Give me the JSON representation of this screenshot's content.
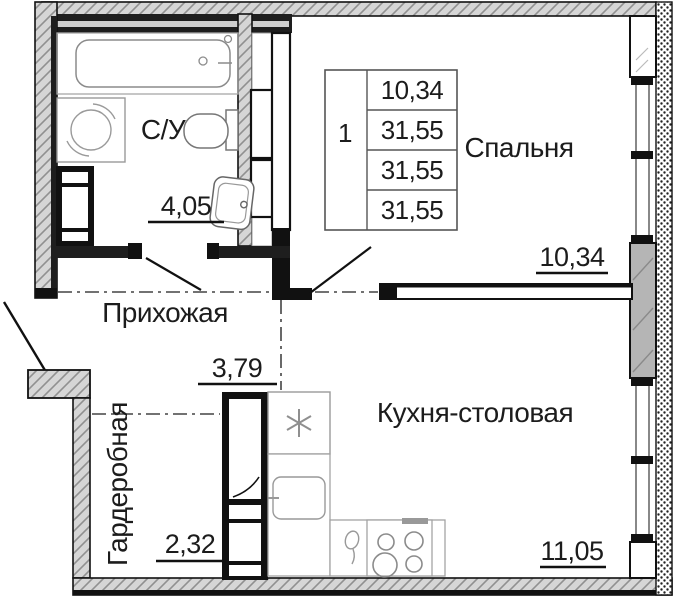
{
  "info_table": {
    "flat_number": "1",
    "values": [
      "10,34",
      "31,55",
      "31,55",
      "31,55"
    ]
  },
  "rooms": {
    "bathroom": {
      "label": "С/У",
      "area": "4,05"
    },
    "bedroom": {
      "label": "Спальня",
      "area": "10,34"
    },
    "hallway": {
      "label": "Прихожая",
      "area": "3,79"
    },
    "wardrobe": {
      "label": "Гардеробная",
      "area": "2,32"
    },
    "kitchen": {
      "label": "Кухня-столовая",
      "area": "11,05"
    }
  },
  "icons": {
    "fridge": "snowflake-icon",
    "washer": "washing-machine-icon",
    "stove": "stove-burners-icon",
    "bathtub": "bathtub-icon",
    "toilet": "toilet-icon",
    "sink": "sink-icon"
  },
  "colors": {
    "wall_line": "#111111",
    "hatch_fill": "#d6d6d6",
    "hatch_line": "#909090",
    "pier_fill": "#b5b5b5",
    "counter_line": "#a3a3a3",
    "text": "#1c1c1c"
  }
}
